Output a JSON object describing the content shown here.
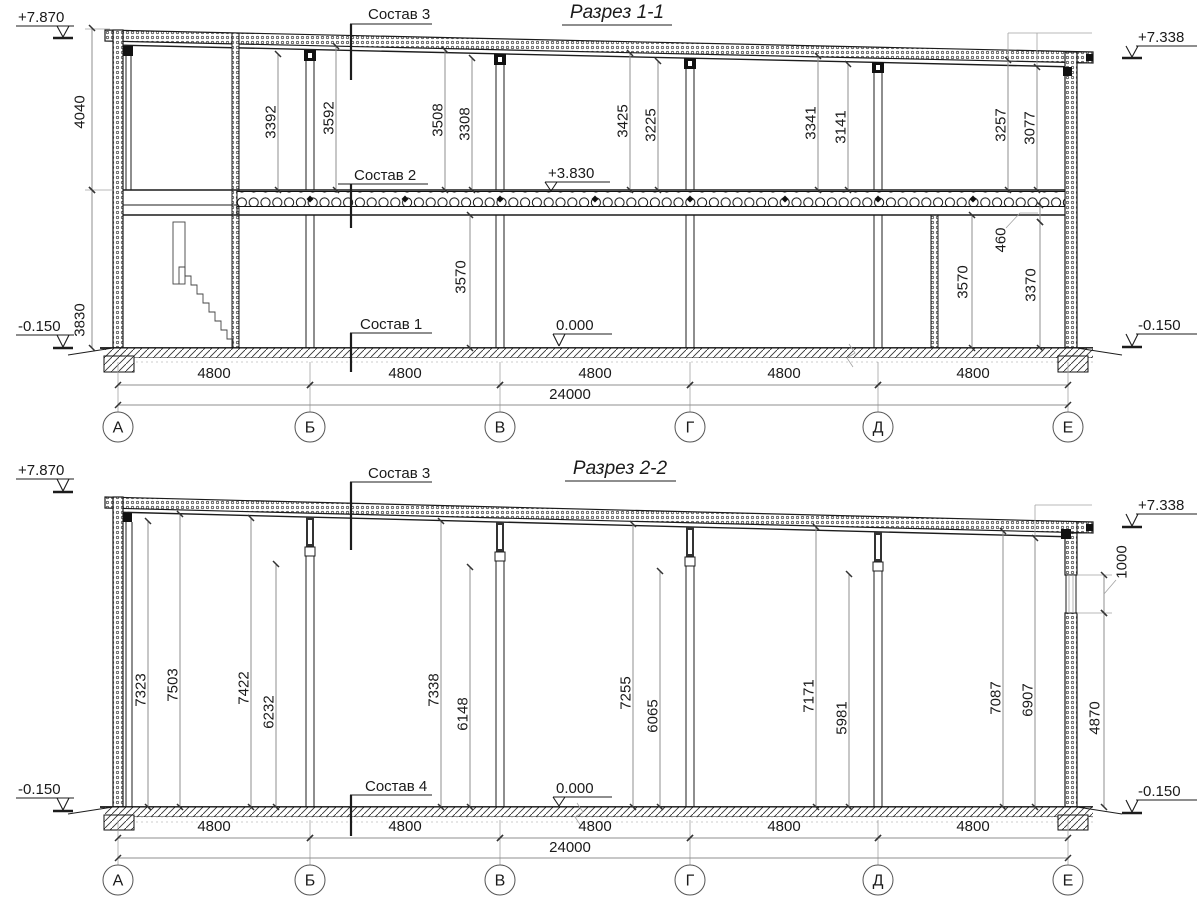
{
  "drawing": {
    "section1": {
      "title": "Разрез 1-1",
      "layer_labels": {
        "l3": "Состав 3",
        "l2": "Состав 2",
        "l1": "Состав 1"
      },
      "elevations": {
        "top_left": "+7.870",
        "top_right": "+7.338",
        "floor2": "+3.830",
        "zero": "0.000",
        "grade_left": "-0.150",
        "grade_right": "-0.150"
      },
      "left_dims": {
        "upper": "4040",
        "lower": "3830"
      },
      "upper_dims": [
        "3392",
        "3592",
        "3508",
        "3308",
        "3425",
        "3225",
        "3341",
        "3141",
        "3257",
        "3077"
      ],
      "lower_dims": {
        "bay_bv": "3570",
        "beam": "460",
        "bay_de_a": "3570",
        "bay_de_b": "3370"
      },
      "bay_dims": [
        "4800",
        "4800",
        "4800",
        "4800",
        "4800"
      ],
      "total_dim": "24000",
      "axes": [
        "А",
        "Б",
        "В",
        "Г",
        "Д",
        "Е"
      ]
    },
    "section2": {
      "title": "Разрез 2-2",
      "layer_labels": {
        "l3": "Состав 3",
        "l4": "Состав 4"
      },
      "elevations": {
        "top_left": "+7.870",
        "top_right": "+7.338",
        "zero": "0.000",
        "grade_left": "-0.150",
        "grade_right": "-0.150"
      },
      "interior_dims": [
        "7323",
        "7503",
        "7422",
        "6232",
        "7338",
        "6148",
        "7255",
        "6065",
        "7171",
        "5981",
        "7087",
        "6907"
      ],
      "right_dims": {
        "window": "1000",
        "wall": "4870"
      },
      "bay_dims": [
        "4800",
        "4800",
        "4800",
        "4800",
        "4800"
      ],
      "total_dim": "24000",
      "axes": [
        "А",
        "Б",
        "В",
        "Г",
        "Д",
        "Е"
      ]
    }
  }
}
